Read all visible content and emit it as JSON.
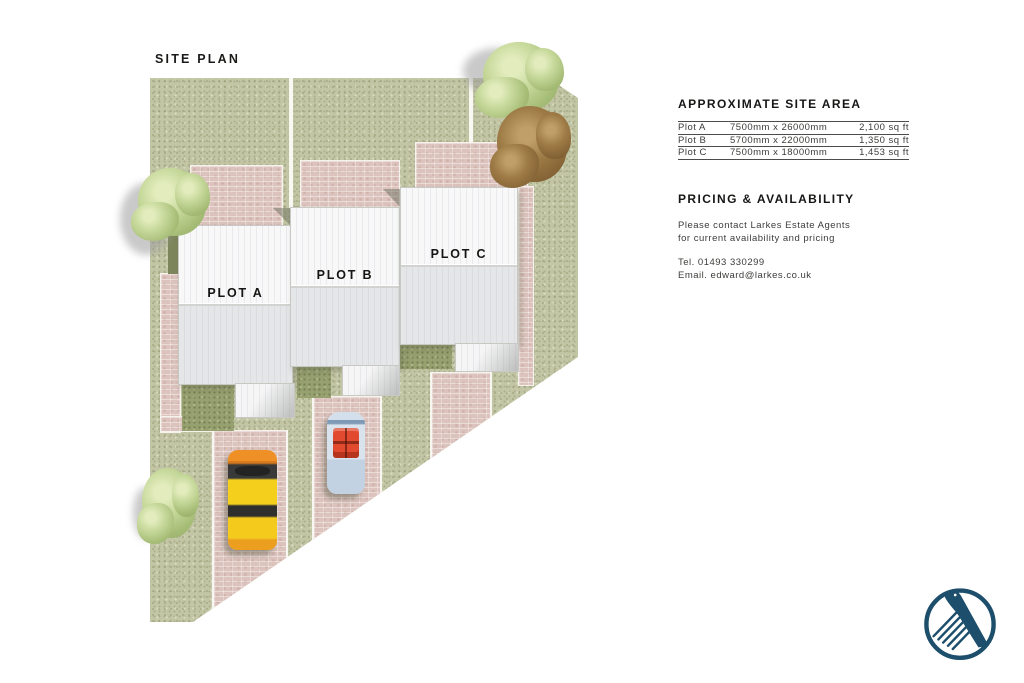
{
  "title": "SITE PLAN",
  "plan": {
    "plots": [
      {
        "label": "PLOT A"
      },
      {
        "label": "PLOT B"
      },
      {
        "label": "PLOT C"
      }
    ]
  },
  "site_area": {
    "heading": "APPROXIMATE SITE AREA",
    "rows": [
      {
        "plot": "Plot A",
        "dimensions": "7500mm x 26000mm",
        "area": "2,100 sq ft"
      },
      {
        "plot": "Plot B",
        "dimensions": "5700mm x 22000mm",
        "area": "1,350 sq ft"
      },
      {
        "plot": "Plot C",
        "dimensions": "7500mm x 18000mm",
        "area": "1,453 sq ft"
      }
    ]
  },
  "pricing": {
    "heading": "PRICING & AVAILABILITY",
    "body_line1": "Please contact Larkes Estate Agents",
    "body_line2": "for current availability and pricing",
    "tel": "Tel. 01493 330299",
    "email": "Email. edward@larkes.co.uk"
  },
  "logo": {
    "name": "larkes-bird-logo",
    "color": "#1d4e6b"
  },
  "colors": {
    "grass": "#c3c6a5",
    "dark_grass": "#97a06f",
    "brick": "#dcc3bd",
    "roof_light": "#f8f8f9",
    "roof_dark": "#e9eaed",
    "text": "#3c3c3a",
    "heading": "#161614",
    "logo_navy": "#1d4e6b",
    "car_yellow": "#f4d01d",
    "car_blue": "#d9e3ee",
    "car_red_seats": "#e14a2f"
  }
}
